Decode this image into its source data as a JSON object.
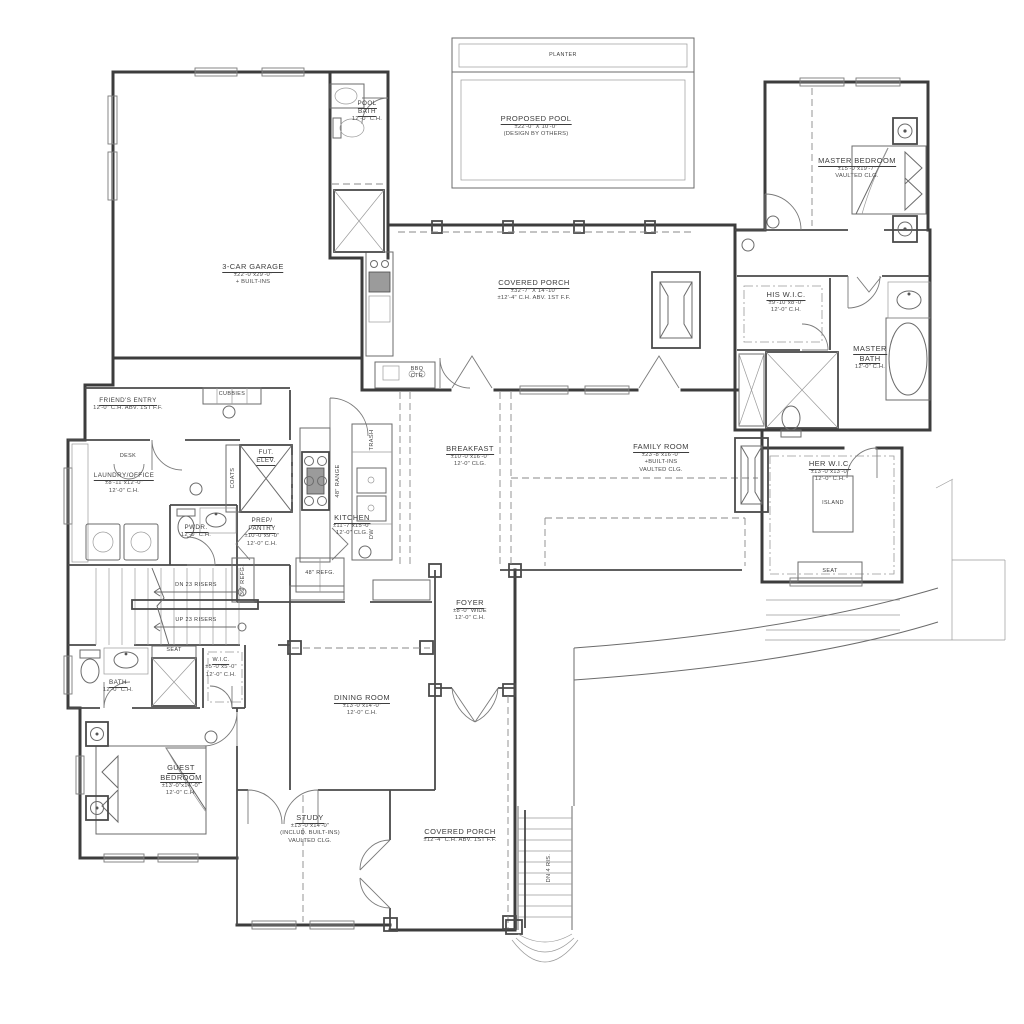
{
  "sheet": {
    "type": "first-floor-plan",
    "background": "#ffffff",
    "line_color": "#3c3c3c",
    "text_color": "#3d3d3d"
  },
  "labels": {
    "planter": {
      "lines": [
        "PLANTER"
      ]
    },
    "pool": {
      "lines": [
        "PROPOSED POOL",
        "±22'-0\" X 10'-0\"",
        "(DESIGN BY OTHERS)"
      ]
    },
    "pool_bath": {
      "lines": [
        "POOL",
        "BATH",
        "12'-0\" C.H."
      ]
    },
    "master_bedroom": {
      "lines": [
        "MASTER BEDROOM",
        "±15'-0\"x19'-7\"",
        "VAULTED CLG."
      ]
    },
    "garage": {
      "lines": [
        "3-CAR GARAGE",
        "±22'-0\"x29'-0\"",
        "+ BUILT-INS"
      ]
    },
    "covered_porch_top": {
      "lines": [
        "COVERED PORCH",
        "±32'-7\" X 14'-10\"",
        "±12'-4\" C.H. ABV. 1ST F.F."
      ]
    },
    "his_wic": {
      "lines": [
        "HIS W.I.C.",
        "±9'-10\"x8'-0\"",
        "12'-0\" C.H."
      ]
    },
    "master_bath": {
      "lines": [
        "MASTER",
        "BATH",
        "12'-0\" C.H."
      ]
    },
    "bbq": {
      "lines": [
        "BBQ",
        "CTR"
      ]
    },
    "friends_entry": {
      "lines": [
        "FRIEND'S ENTRY",
        "12'-0\" C.H. ABV. 1ST F.F."
      ]
    },
    "cubbies": {
      "lines": [
        "CUBBIES"
      ]
    },
    "desk": {
      "lines": [
        "DESK"
      ]
    },
    "laundry": {
      "lines": [
        "LAUNDRY/OFFICE",
        "±8'-11\"x12'-0\"",
        "12'-0\" C.H."
      ]
    },
    "fut_elev": {
      "lines": [
        "FUT.",
        "ELEV."
      ]
    },
    "breakfast": {
      "lines": [
        "BREAKFAST",
        "±10'-0\"x16'-0\"",
        "12'-0\" CLG."
      ]
    },
    "family_room": {
      "lines": [
        "FAMILY ROOM",
        "±23'-8\"x16'-0\"",
        "+BUILT-INS",
        "VAULTED CLG."
      ]
    },
    "her_wic": {
      "lines": [
        "HER W.I.C.",
        "±13'-0\"x13'-0\"",
        "12'-0\" C.H."
      ]
    },
    "island": {
      "lines": [
        "ISLAND"
      ]
    },
    "seat_her_wic": {
      "lines": [
        "SEAT"
      ]
    },
    "kitchen": {
      "lines": [
        "KITCHEN",
        "±11'-7\"x15'-0\"",
        "12'-0\" CLG."
      ]
    },
    "prep_pantry": {
      "lines": [
        "PREP/",
        "PANTRY",
        "±10'-0\"x9'-0\"",
        "12'-0\" C.H."
      ]
    },
    "pwdr": {
      "lines": [
        "PWDR.",
        "12'-0\" C.H."
      ]
    },
    "coats": {
      "lines": [
        "COATS"
      ]
    },
    "trash": {
      "lines": [
        "TRASH"
      ]
    },
    "range": {
      "lines": [
        "48\" RANGE"
      ]
    },
    "dw": {
      "lines": [
        "DW"
      ]
    },
    "refg48": {
      "lines": [
        "48\" REFG."
      ]
    },
    "refg36": {
      "lines": [
        "36\" REFG."
      ]
    },
    "stairs_dn": {
      "lines": [
        "DN 23 RISERS"
      ]
    },
    "stairs_up": {
      "lines": [
        "UP 23 RISERS"
      ]
    },
    "foyer": {
      "lines": [
        "FOYER",
        "±8'-0\" WIDE",
        "12'-0\" C.H."
      ]
    },
    "dining": {
      "lines": [
        "DINING ROOM",
        "±13'-0\"x14'-0\"",
        "12'-0\" C.H."
      ]
    },
    "seat_bench": {
      "lines": [
        "SEAT"
      ]
    },
    "bath2": {
      "lines": [
        "BATH",
        "12'-0\" C.H."
      ]
    },
    "wic2": {
      "lines": [
        "W.I.C.",
        "±5'-0\"x5'-0\"",
        "12'-0\" C.H."
      ]
    },
    "guest": {
      "lines": [
        "GUEST",
        "BEDROOM",
        "±13'-0\"x14'-0\"",
        "12'-0\" C.H."
      ]
    },
    "study": {
      "lines": [
        "STUDY",
        "±13'-0\"x14'-0\"",
        "(INCLUD. BUILT-INS)",
        "VAULTED CLG."
      ]
    },
    "covered_porch_bottom": {
      "lines": [
        "COVERED PORCH",
        "±12'-4\" C.H. ABV. 1ST F.F."
      ]
    },
    "dn4": {
      "lines": [
        "DN 4 RIS."
      ]
    }
  }
}
